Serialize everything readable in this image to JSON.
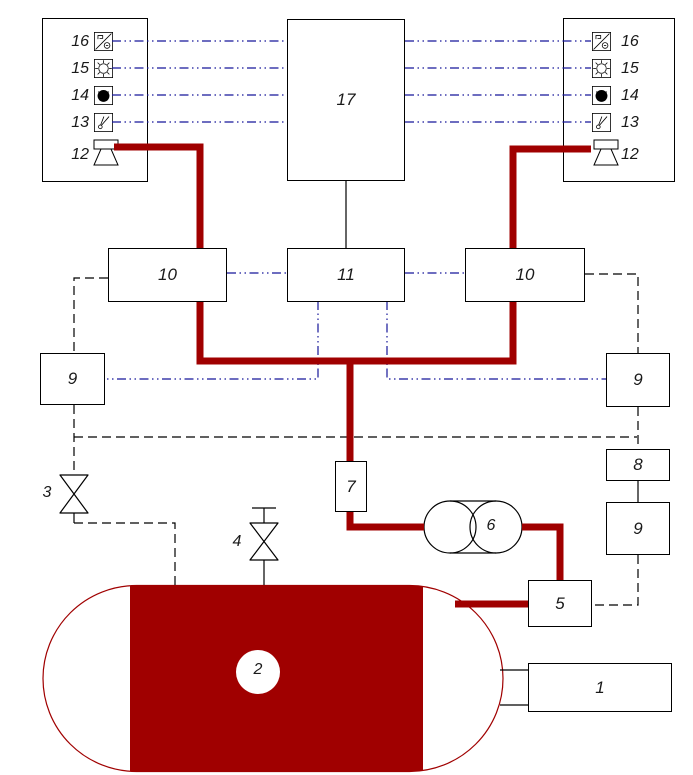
{
  "colors": {
    "pipe_red": "#a00000",
    "signal_blue": "#16169a",
    "line_black": "#000000",
    "background": "#ffffff"
  },
  "panels": {
    "left": {
      "items": [
        {
          "label": "16",
          "icon": "recorder-icon"
        },
        {
          "label": "15",
          "icon": "lamp-icon"
        },
        {
          "label": "14",
          "icon": "indicator-icon"
        },
        {
          "label": "13",
          "icon": "switch-icon"
        },
        {
          "label": "12",
          "icon": "siren-icon"
        }
      ]
    },
    "right": {
      "items": [
        {
          "label": "16",
          "icon": "recorder-icon"
        },
        {
          "label": "15",
          "icon": "lamp-icon"
        },
        {
          "label": "14",
          "icon": "indicator-icon"
        },
        {
          "label": "13",
          "icon": "switch-icon"
        },
        {
          "label": "12",
          "icon": "siren-icon"
        }
      ]
    }
  },
  "blocks": {
    "block17": "17",
    "block10_left": "10",
    "block11": "11",
    "block10_right": "10",
    "block9_left": "9",
    "block9_right": "9",
    "block8": "8",
    "block9_lower": "9",
    "block7": "7",
    "block6": "6",
    "block5": "5",
    "block1": "1",
    "tank": "2",
    "valve3": "3",
    "valve4": "4"
  }
}
